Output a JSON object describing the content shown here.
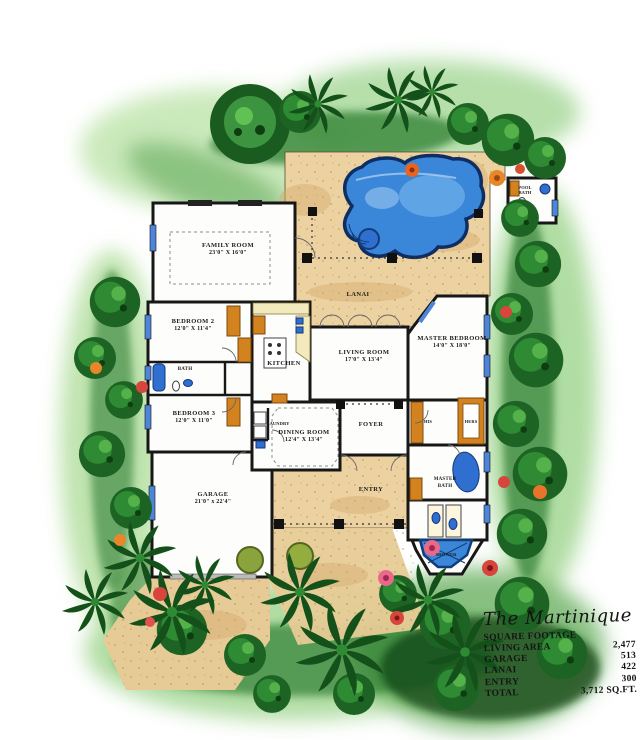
{
  "title": "The Martinique",
  "footage_table": {
    "header": "SQUARE FOOTAGE",
    "rows": [
      {
        "label": "LIVING AREA",
        "value": "2,477"
      },
      {
        "label": "GARAGE",
        "value": "513"
      },
      {
        "label": "LANAI",
        "value": "422"
      },
      {
        "label": "ENTRY",
        "value": "300"
      },
      {
        "label": "TOTAL",
        "value": "3,712 SQ.FT."
      }
    ]
  },
  "rooms": {
    "family_room": {
      "name": "FAMILY ROOM",
      "dims": "23'0\" X 16'0\""
    },
    "bedroom2": {
      "name": "BEDROOM 2",
      "dims": "12'0\" X 11'4\""
    },
    "bedroom3": {
      "name": "BEDROOM 3",
      "dims": "12'0\" X 11'0\""
    },
    "bath": {
      "name": "BATH"
    },
    "kitchen": {
      "name": "KITCHEN"
    },
    "laundry": {
      "name": "LAUNDRY"
    },
    "living_room": {
      "name": "LIVING ROOM",
      "dims": "17'0\" X 13'4\""
    },
    "master_bedroom": {
      "name": "MASTER BEDROOM",
      "dims": "14'0\" X 18'0\""
    },
    "dining_room": {
      "name": "DINING ROOM",
      "dims": "12'4\" X 13'4\""
    },
    "foyer": {
      "name": "FOYER"
    },
    "garage": {
      "name": "GARAGE",
      "dims": "21'0\" x 22'4\""
    },
    "lanai": {
      "name": "LANAI"
    },
    "entry": {
      "name": "ENTRY"
    },
    "his_closet": {
      "name": "HIS"
    },
    "hers_closet": {
      "name": "HERS"
    },
    "master_bath": {
      "line1": "MASTER",
      "line2": "BATH"
    },
    "shower": {
      "name": "SHOWER"
    },
    "pool_bath": {
      "line1": "POOL",
      "line2": "BATH"
    }
  },
  "colors": {
    "pool_water": "#3a86d8",
    "deck_tan": "#ecd2a0",
    "wall_ink": "#171717",
    "closet_orange": "#d2821e",
    "foliage_dark": "#1d6323",
    "foliage_light": "#9cd584",
    "flower_red": "#da4340"
  }
}
